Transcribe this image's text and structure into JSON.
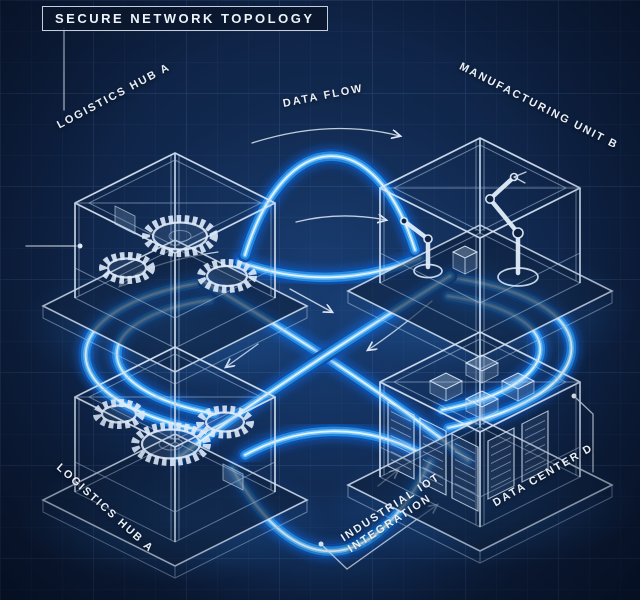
{
  "title": "SECURE NETWORK TOPOLOGY",
  "flow_label": "DATA FLOW",
  "integration": {
    "line1": "INDUSTRIAL IOT",
    "line2": "INTEGRATION"
  },
  "nodes": {
    "top_left": {
      "label": "LOGISTICS HUB A",
      "icon": "gears-icon"
    },
    "top_right": {
      "label": "MANUFACTURING UNIT B",
      "icon": "robot-arm-icon"
    },
    "bottom_left": {
      "label": "LOGISTICS HUB A",
      "icon": "gears-icon"
    },
    "bottom_right": {
      "label": "DATA CENTER D",
      "icon": "server-rack-icon"
    }
  },
  "colors": {
    "background": "#0e2244",
    "grid": "#2a4a7a",
    "tube_deep": "#0d4fa6",
    "tube_mid": "#2488e0",
    "tube_bright": "#6fc0f8",
    "tube_core": "#eaf7ff",
    "wireframe": "#d6e4f4",
    "label_text": "#e9eff8"
  }
}
